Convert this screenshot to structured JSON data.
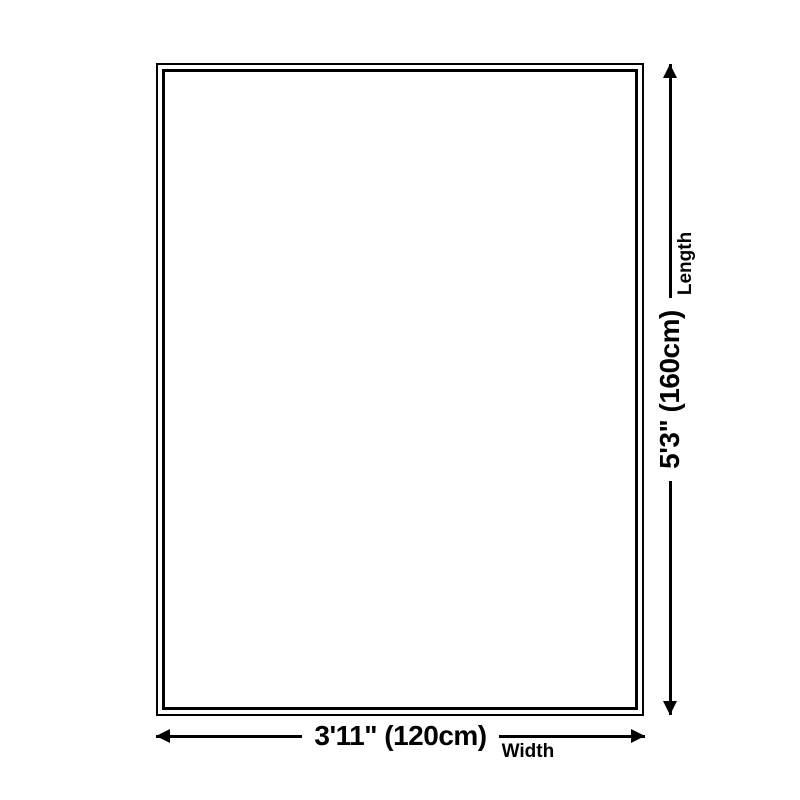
{
  "page": {
    "background_color": "#ffffff",
    "line_color": "#000000",
    "description": "Product size diagram with rectangular outline and dimension arrows"
  },
  "outline": {
    "shape": "rectangle",
    "border_style": "double"
  },
  "dimensions": {
    "width": {
      "value": "3'11\" (120cm)",
      "label": "Width"
    },
    "length": {
      "value": "5'3\" (160cm)",
      "label": "Length"
    }
  }
}
